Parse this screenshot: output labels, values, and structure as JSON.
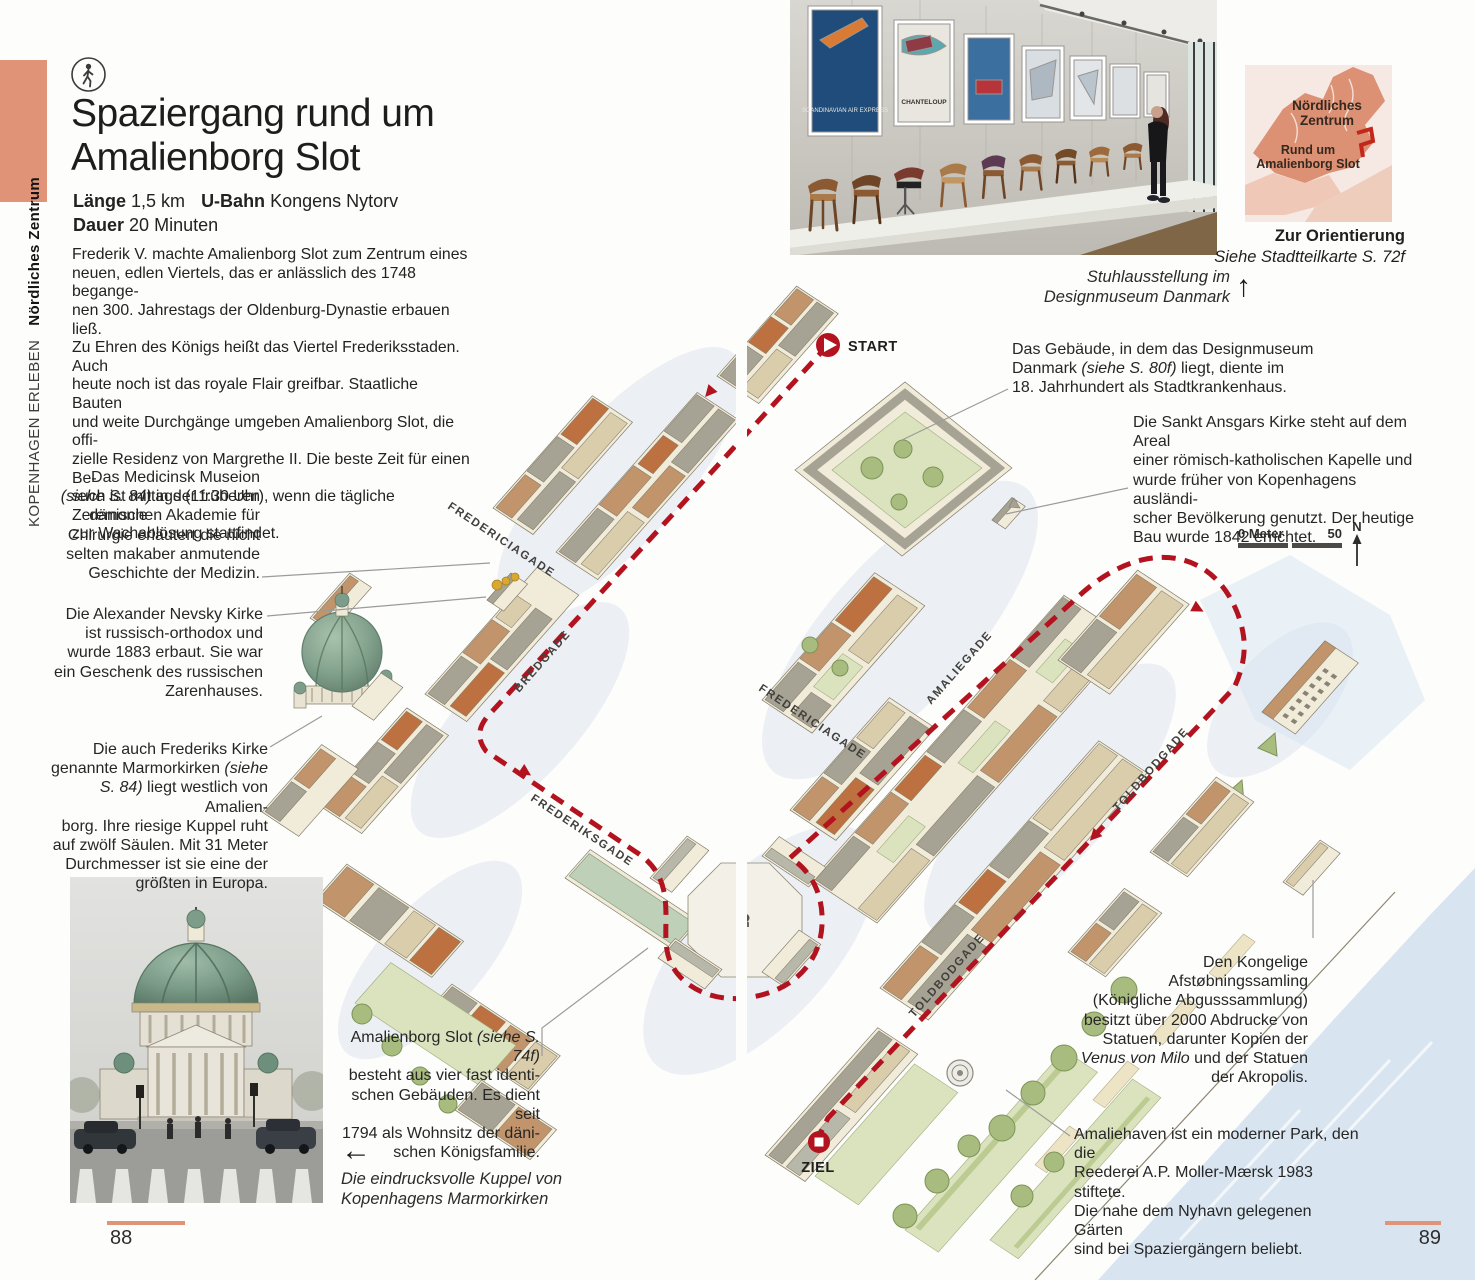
{
  "sidebar": {
    "series": "KOPENHAGEN ERLEBEN",
    "chapter": "Nördliches Zentrum"
  },
  "header": {
    "title": "Spaziergang rund um\nAmalienborg Slot",
    "length_label": "Länge",
    "length_value": "1,5 km",
    "ubahn_label": "U-Bahn",
    "ubahn_value": "Kongens Nytorv",
    "duration_label": "Dauer",
    "duration_value": "20 Minuten"
  },
  "intro": "Frederik V. machte Amalienborg Slot zum Zentrum eines\nneuen, edlen Viertels, das er anlässlich des 1748 begange-\nnen 300. Jahrestags der Oldenburg-Dynastie erbauen ließ.\nZu Ehren des Königs heißt das Viertel Frederiksstaden. Auch\nheute noch ist das royale Flair greifbar. Staatliche Bauten\nund weite Durchgänge umgeben Amalienborg Slot, die offi-\nzielle Residenz von Margrethe II. Die beste Zeit für einen Be-\nsuch ist mittags (11:30 Uhr), wenn die tägliche Zeremonie\nzur Wachablösung stattfindet.",
  "annotations": {
    "medicinsk": {
      "pre": "Das Medicinsk Museion\n",
      "ref": "(siehe S. 84)",
      "post": " in der früheren\ndänischen Akademie für\nChirurgie erläutert die nicht\nselten makaber anmutende\nGeschichte der Medizin."
    },
    "nevsky": {
      "text": "Die Alexander Nevsky Kirke\nist russisch-orthodox und\nwurde 1883 erbaut. Sie war\nein Geschenk des russischen\nZarenhauses."
    },
    "marmorkirken": {
      "pre": "Die auch Frederiks Kirke\ngenannte Marmorkirken ",
      "ref": "(siehe\nS. 84)",
      "post": " liegt westlich von Amalien-\nborg. Ihre riesige Kuppel ruht\nauf zwölf Säulen. Mit 31 Meter\nDurchmesser ist sie eine der\ngrößten in Europa."
    },
    "amalienborg": {
      "pre": "Amalienborg Slot ",
      "ref": "(siehe S. 74f)",
      "post": "\nbesteht aus vier fast identi-\nschen Gebäuden. Es dient seit\n1794 als Wohnsitz der däni-\nschen Königsfamilie."
    },
    "designmuseum": {
      "pre": "Das Gebäude, in dem das Designmuseum\nDanmark ",
      "ref": "(siehe S. 80f)",
      "post": " liegt, diente im\n18. Jahrhundert als Stadtkrankenhaus."
    },
    "ansgars": {
      "text": "Die Sankt Ansgars Kirke steht auf dem Areal\neiner römisch-katholischen Kapelle und\nwurde früher von Kopenhagens ausländi-\nscher Bevölkerung genutzt. Der heutige\nBau wurde 1842 errichtet."
    },
    "afstoebning": {
      "pre": "Den Kongelige\nAfstøbningssamling\n(Königliche Abgusssammlung)\nbesitzt über 2000 Abdrucke von\nStatuen, darunter Kopien der\n",
      "ref": "Venus von Milo",
      "post": " und der Statuen\nder Akropolis."
    },
    "amaliehaven": {
      "text": "Amaliehaven ist ein moderner Park, den die\nReederei A.P. Moller-Mærsk 1983 stiftete.\nDie nahe dem Nyhavn gelegenen Gärten\nsind bei Spaziergängern beliebt."
    }
  },
  "captions": {
    "museum_photo": "Stuhlausstellung im\nDesignmuseum Danmark",
    "church_photo": "Die eindrucksvolle Kuppel von\nKopenhagens Marmorkirken",
    "up_arrow": "↑",
    "left_arrow": "←"
  },
  "photos": {
    "museum": {
      "poster1": "SCANDINAVIAN\nAIR EXPRESS",
      "poster2": "CHANTELOUP"
    }
  },
  "orientation": {
    "region": "Nördliches\nZentrum",
    "route": "Rund um\nAmalienborg Slot",
    "title": "Zur Orientierung",
    "subtitle": "Siehe Stadtteilkarte S. 72f"
  },
  "map": {
    "streets": {
      "fredericiagade_w": "FREDERICIAGADE",
      "fredericiagade_e": "FREDERICIAGADE",
      "bredgade": "BREDGADE",
      "frederiksgade": "FREDERIKSGADE",
      "amaliegade": "AMALIEGADE",
      "toldbodgade_n": "TOLDBODGADE",
      "toldbodgade_s": "TOLDBODGADE"
    },
    "markers": {
      "start": "START",
      "ziel": "ZIEL"
    },
    "scale": {
      "zero": "0 Meter",
      "fifty": "50",
      "north": "N"
    },
    "route_color": "#B2131F",
    "accent_color": "#E09376"
  },
  "pagination": {
    "left": "88",
    "right": "89"
  }
}
